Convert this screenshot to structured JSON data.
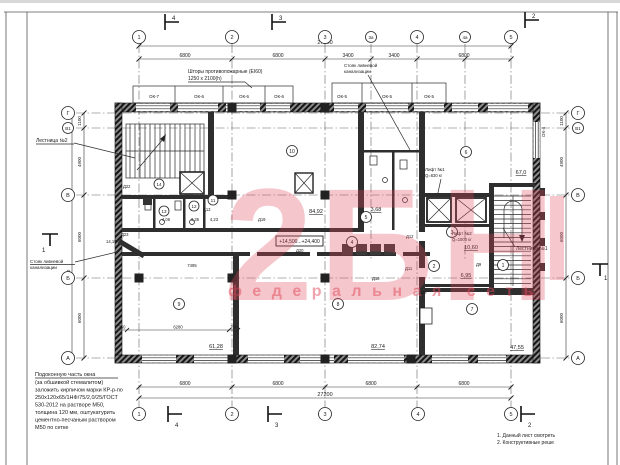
{
  "sheet": {
    "watermark_letters": "2БН",
    "watermark_subtitle": "федеральная сеть",
    "watermark_color": "#e0485a"
  },
  "grid": {
    "top": [
      "1",
      "2",
      "3",
      "3а",
      "4",
      "4а",
      "5"
    ],
    "bottom": [
      "1",
      "2",
      "3",
      "4",
      "5"
    ],
    "left": [
      "Г",
      "В1",
      "В",
      "Б",
      "А"
    ],
    "right": [
      "Г",
      "В1",
      "В",
      "Б",
      "А"
    ]
  },
  "dims": {
    "top_total": "27200",
    "top_segs": [
      "6800",
      "6800",
      "3400",
      "3400",
      "6800"
    ],
    "bottom_segs": [
      "6800",
      "6800",
      "6800",
      "6800"
    ],
    "bottom_total": "27200",
    "left_segs": [
      "1100",
      "4900",
      "6000",
      "6000"
    ],
    "left_outer": "10000",
    "right_segs": [
      "1100",
      "4900",
      "6000",
      "6000"
    ],
    "interior": [
      "7495",
      "750",
      "6280",
      "750"
    ]
  },
  "sections": {
    "top": [
      "4",
      "3",
      "2"
    ],
    "bottom": [
      "4",
      "3",
      "2"
    ],
    "left": "1",
    "right": "1"
  },
  "windows": {
    "top": [
      "ОК-7",
      "ОК-6",
      "ОК-6",
      "ОК-6",
      "ОК-5",
      "ОК-5",
      "ОК-5"
    ],
    "right": "ОК-4"
  },
  "rooms": [
    {
      "num": "1"
    },
    {
      "num": "2",
      "area": "6,95"
    },
    {
      "num": "3",
      "area": "10,60"
    },
    {
      "num": "4"
    },
    {
      "num": "5",
      "area": "3,68"
    },
    {
      "num": "6",
      "area": "67,0"
    },
    {
      "num": "7",
      "area": "47,55"
    },
    {
      "num": "8",
      "area": "82,74"
    },
    {
      "num": "9",
      "area": "61,28"
    },
    {
      "num": "10",
      "area": "84,92"
    },
    {
      "num": "11",
      "area": "4,23"
    },
    {
      "num": "12",
      "area": "3,35"
    },
    {
      "num": "13",
      "area": "4,06"
    },
    {
      "num": "14"
    }
  ],
  "doors": [
    "Д22",
    "Д23",
    "Д13",
    "Д19",
    "Д20",
    "Д12",
    "Д11",
    "Д16",
    "Д19",
    "Д9"
  ],
  "lifts": [
    {
      "name": "Лифт №1",
      "cap": "Q=630 кг"
    },
    {
      "name": "Лифт №2",
      "cap": "Q=1000 кг"
    }
  ],
  "stairs": {
    "s1": "Лестница №1",
    "s2": "Лестница №2"
  },
  "annotations": {
    "curtains_1": "Шторы противопожарные (EI60)",
    "curtains_2": "1250 х 2100(h)",
    "riser_1": "Стояк ливневой",
    "riser_2": "канализации",
    "elevation_range": "+14,500...+24,400",
    "elevation_mark": "14,15"
  },
  "notes": {
    "left": [
      "Подоконную часть окна",
      "(за обшивкой стемалитом)",
      "заложить кирпичом марки КР-р-по",
      "250х120х65/1НФ/75/2,0/25/ГОСТ",
      "530-2012 на растворе М50,",
      "толщина 120 мм, оштукатурить",
      "цементно-песчаным раствором",
      "М50 по сетке"
    ],
    "right": [
      "1. Данный лист смотреть",
      "2. Конструктивные реше"
    ]
  }
}
